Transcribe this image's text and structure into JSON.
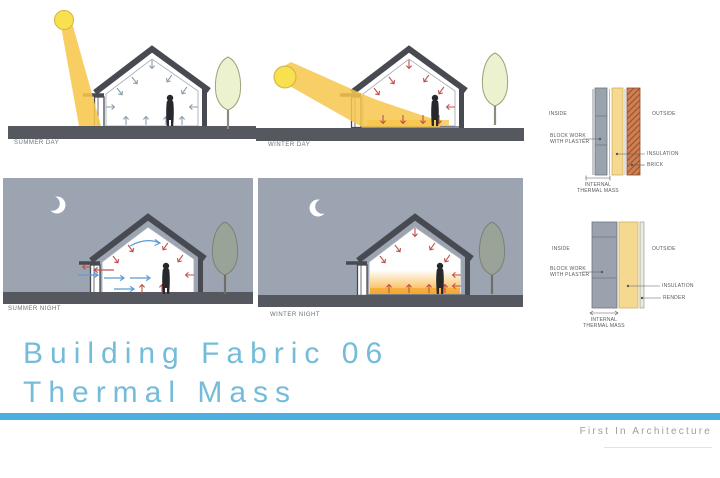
{
  "title": {
    "line1": "Building Fabric 06",
    "line2": "Thermal Mass"
  },
  "footer": {
    "brand": "First In Architecture"
  },
  "scenes": [
    {
      "id": "summer-day",
      "label": "SUMMER DAY"
    },
    {
      "id": "winter-day",
      "label": "WINTER DAY"
    },
    {
      "id": "summer-night",
      "label": "SUMMER NIGHT"
    },
    {
      "id": "winter-night",
      "label": "WINTER NIGHT"
    }
  ],
  "wall_details": [
    {
      "inside_label": "INSIDE",
      "outside_label": "OUTSIDE",
      "layer1_line1": "BLOCK WORK",
      "layer1_line2": "WITH PLASTER",
      "layer2": "INSULATION",
      "layer3": "BRICK",
      "dim_line1": "INTERNAL",
      "dim_line2": "THERMAL MASS"
    },
    {
      "inside_label": "INSIDE",
      "outside_label": "OUTSIDE",
      "layer1_line1": "BLOCK WORK",
      "layer1_line2": "WITH PLASTER",
      "layer2": "INSULATION",
      "layer3": "RENDER",
      "dim_line1": "INTERNAL",
      "dim_line2": "THERMAL MASS"
    }
  ],
  "colors": {
    "accent_bar": "#4dafdf",
    "title_text": "#74bcd9",
    "brand_text": "#9e9e9e",
    "night_sky": "#9ca3b1",
    "sun": "#f9e04f",
    "sun_beam": "#f7c64b",
    "ground": "#55585e",
    "structure": "#474a51",
    "insulation": "#f5d990",
    "brick": "#cd7f53",
    "blockwork": "#9aa3ad",
    "tree_day": "#ecf2cf",
    "tree_night": "#9aa398",
    "heat_arrow": "#c0504d",
    "cool_arrow": "#5b9bd5"
  }
}
